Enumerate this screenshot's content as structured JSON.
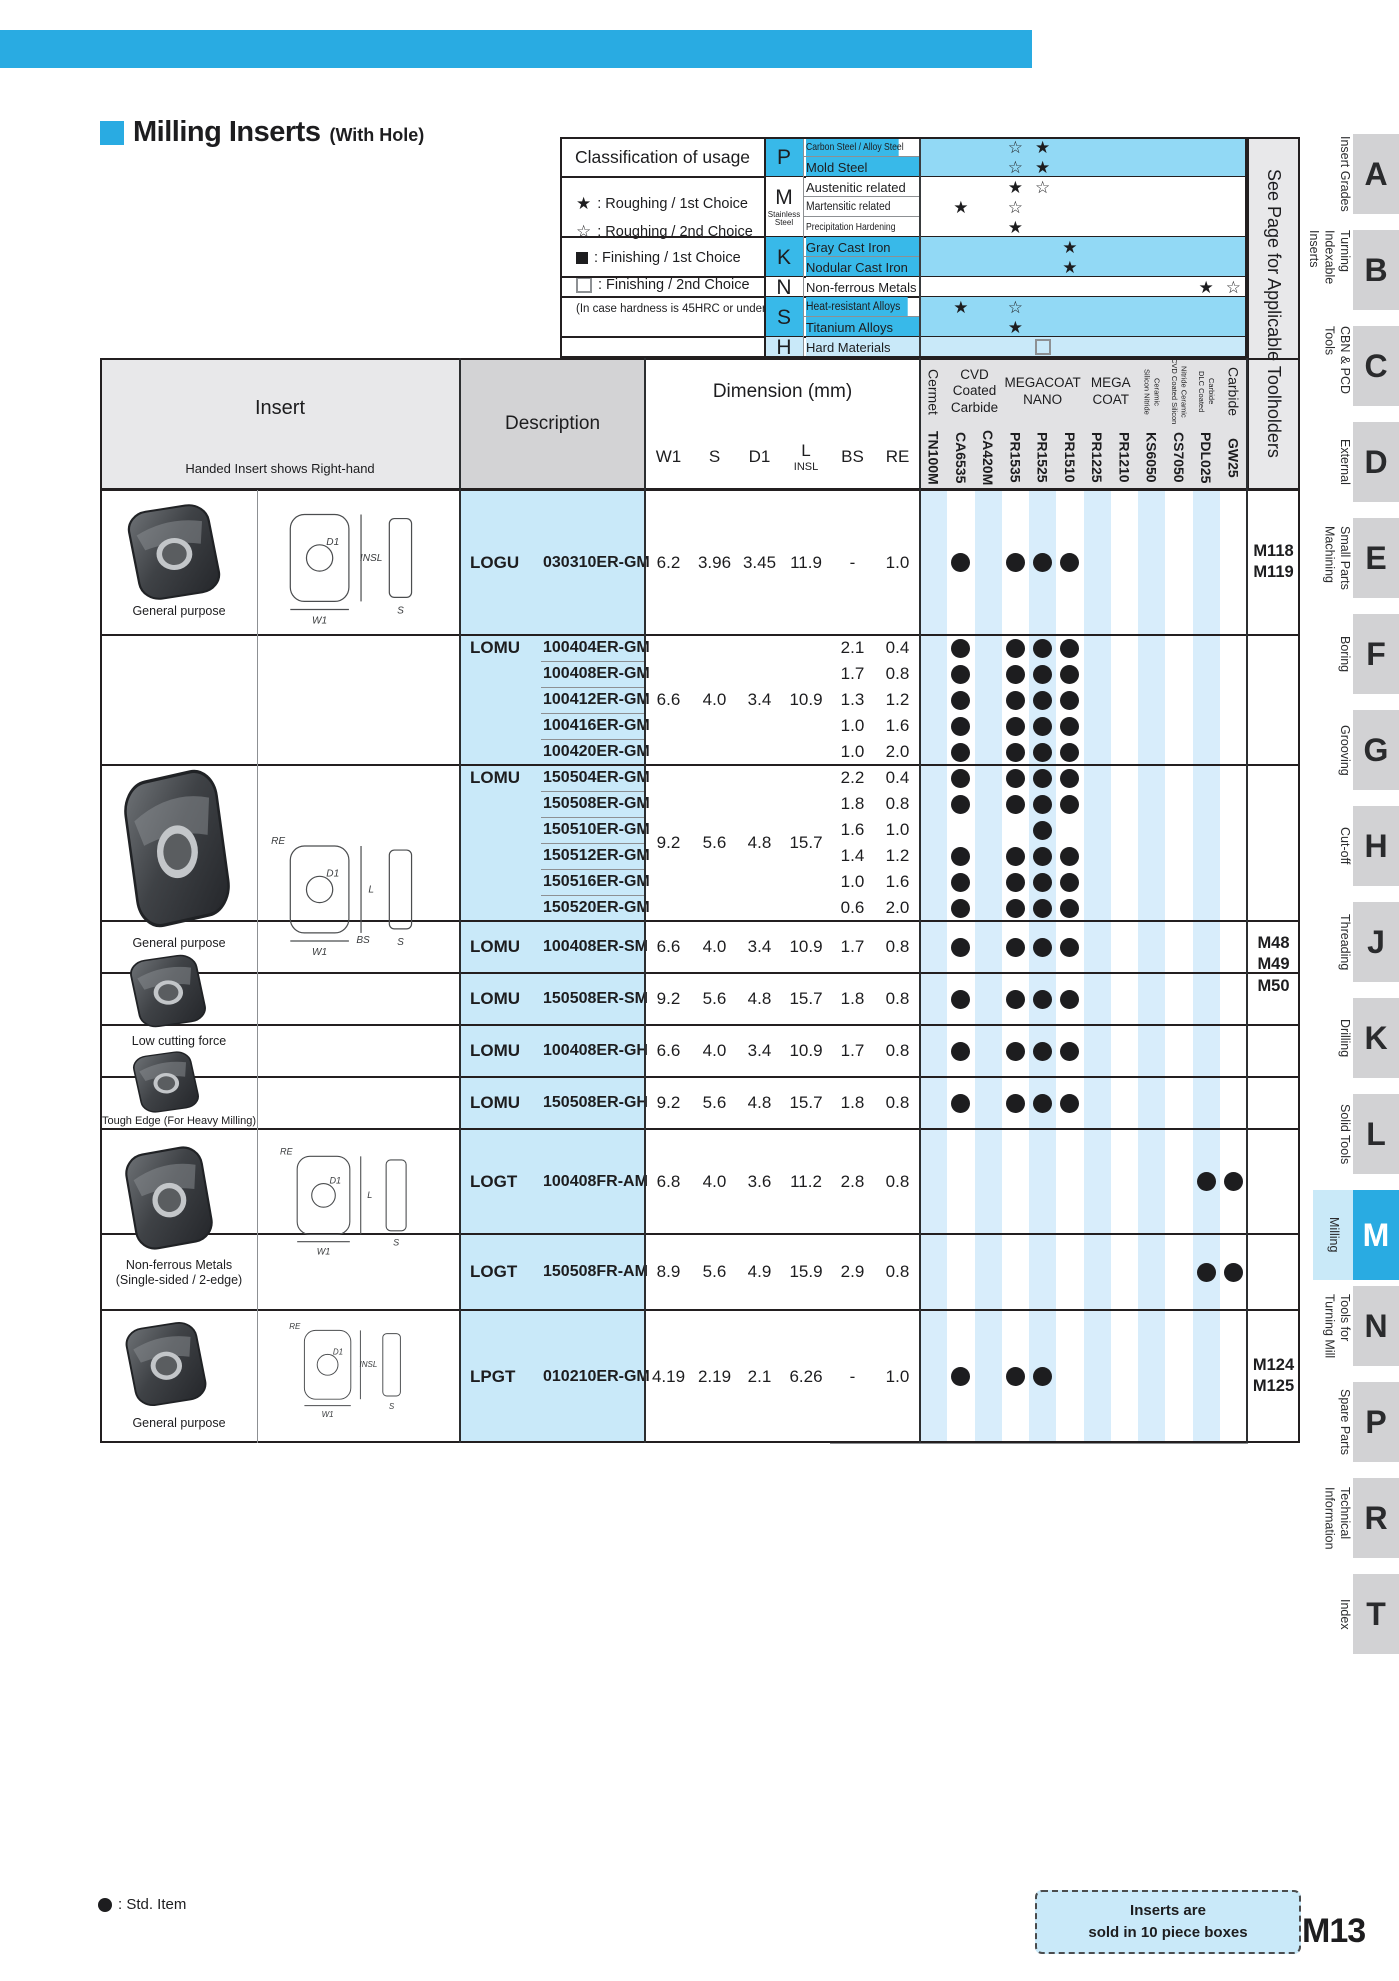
{
  "page": {
    "title": "Milling Inserts",
    "title_suffix": "(With Hole)",
    "std_item_legend": ": Std. Item",
    "box_note_line1": "Inserts are",
    "box_note_line2": "sold in 10 piece boxes",
    "page_number": "M13"
  },
  "colors": {
    "accent": "#29abe2",
    "class_label": "#38b9e9",
    "class_grid": "#92d9f5",
    "lightblue": "#c9e9f9",
    "col_shade": "#d8edfb",
    "head_gray1": "#e8e8ea",
    "head_gray2": "#d3d3d5",
    "head_gray3": "#e2e2e4",
    "tab_gray": "#d2d2d4",
    "tab_active_label_bg": "#c9e9f8",
    "border_dark": "#231f20",
    "border_mid": "#8d9093",
    "ink": "#1d1d1f"
  },
  "classification": {
    "header": "Classification of usage",
    "legend": [
      {
        "sym": "star_filled",
        "text": ": Roughing / 1st Choice"
      },
      {
        "sym": "star_open",
        "text": ": Roughing / 2nd Choice"
      },
      {
        "sym": "square_filled",
        "text": ": Finishing / 1st Choice"
      },
      {
        "sym": "square_open",
        "text": ": Finishing / 2nd Choice"
      },
      {
        "sym": "none",
        "text": "(In case hardness is 45HRC or under)"
      }
    ],
    "groups": [
      {
        "letter": "P",
        "sub": "",
        "shade": "cyan",
        "rows": [
          {
            "label": "Carbon Steel / Alloy Steel",
            "marks": {
              "3": "star_open",
              "4": "star_filled"
            }
          },
          {
            "label": "Mold Steel",
            "marks": {
              "3": "star_open",
              "4": "star_filled"
            }
          }
        ]
      },
      {
        "letter": "M",
        "sub": "Stainless Steel",
        "shade": "white",
        "rows": [
          {
            "label": "Austenitic related",
            "marks": {
              "3": "star_filled",
              "4": "star_open"
            }
          },
          {
            "label": "Martensitic related",
            "marks": {
              "1": "star_filled",
              "3": "star_open"
            }
          },
          {
            "label": "Precipitation Hardening",
            "marks": {
              "3": "star_filled"
            }
          }
        ]
      },
      {
        "letter": "K",
        "sub": "",
        "shade": "cyan",
        "rows": [
          {
            "label": "Gray Cast Iron",
            "marks": {
              "5": "star_filled"
            }
          },
          {
            "label": "Nodular Cast Iron",
            "marks": {
              "5": "star_filled"
            }
          }
        ]
      },
      {
        "letter": "N",
        "sub": "",
        "shade": "white",
        "rows": [
          {
            "label": "Non-ferrous Metals",
            "marks": {
              "10": "star_filled",
              "11": "star_open"
            }
          }
        ]
      },
      {
        "letter": "S",
        "sub": "",
        "shade": "cyan",
        "rows": [
          {
            "label": "Heat-resistant Alloys",
            "marks": {
              "1": "star_filled",
              "3": "star_open"
            }
          },
          {
            "label": "Titanium Alloys",
            "marks": {
              "3": "star_filled"
            }
          }
        ]
      },
      {
        "letter": "H",
        "sub": "",
        "shade": "lightblue",
        "rows": [
          {
            "label": "Hard Materials",
            "marks": {
              "4": "square_open"
            }
          }
        ]
      }
    ]
  },
  "table": {
    "insert_header": "Insert",
    "insert_note": "Handed Insert shows Right-hand",
    "description_header": "Description",
    "dimension_header": "Dimension (mm)",
    "dim_columns": [
      [
        "W1"
      ],
      [
        "S"
      ],
      [
        "D1"
      ],
      [
        "L",
        "INSL"
      ],
      [
        "BS"
      ],
      [
        "RE"
      ]
    ],
    "grade_groups": [
      {
        "lines": [
          "Cermet"
        ],
        "span": 1,
        "mode": "v"
      },
      {
        "lines": [
          "CVD",
          "Coated",
          "Carbide"
        ],
        "span": 2,
        "mode": "h"
      },
      {
        "lines": [
          "MEGACOAT",
          "NANO"
        ],
        "span": 3,
        "mode": "h"
      },
      {
        "lines": [
          "MEGA",
          "COAT"
        ],
        "span": 2,
        "mode": "h"
      },
      {
        "lines": [
          "Silicon Nitride",
          "Ceramic"
        ],
        "span": 1,
        "mode": "vs"
      },
      {
        "lines": [
          "CVD Coated Silicon",
          "Nitride Ceramic"
        ],
        "span": 1,
        "mode": "vs"
      },
      {
        "lines": [
          "DLC Coated",
          "Carbide"
        ],
        "span": 1,
        "mode": "vs"
      },
      {
        "lines": [
          "Carbide"
        ],
        "span": 1,
        "mode": "v"
      }
    ],
    "grades": [
      "TN100M",
      "CA6535",
      "CA420M",
      "PR1535",
      "PR1525",
      "PR1510",
      "PR1225",
      "PR1210",
      "KS6050",
      "CS7050",
      "PDL025",
      "GW25"
    ],
    "see_page_header": "See Page for Applicable Toolholders",
    "sections": [
      {
        "id": "logu",
        "series": "LOGU",
        "dims": {
          "w1": "6.2",
          "s": "3.96",
          "d1": "3.45",
          "l": "11.9"
        },
        "rows": [
          {
            "code": "030310ER-GM",
            "bs": "-",
            "re": "1.0",
            "dots": [
              1,
              3,
              4,
              5
            ]
          }
        ]
      },
      {
        "id": "gm1",
        "series": "LOMU",
        "dims": {
          "w1": "6.6",
          "s": "4.0",
          "d1": "3.4",
          "l": "10.9"
        },
        "rows": [
          {
            "code": "100404ER-GM",
            "bs": "2.1",
            "re": "0.4",
            "dots": [
              1,
              3,
              4,
              5
            ]
          },
          {
            "code": "100408ER-GM",
            "bs": "1.7",
            "re": "0.8",
            "dots": [
              1,
              3,
              4,
              5
            ]
          },
          {
            "code": "100412ER-GM",
            "bs": "1.3",
            "re": "1.2",
            "dots": [
              1,
              3,
              4,
              5
            ]
          },
          {
            "code": "100416ER-GM",
            "bs": "1.0",
            "re": "1.6",
            "dots": [
              1,
              3,
              4,
              5
            ]
          },
          {
            "code": "100420ER-GM",
            "bs": "1.0",
            "re": "2.0",
            "dots": [
              1,
              3,
              4,
              5
            ]
          }
        ]
      },
      {
        "id": "gm2",
        "series": "LOMU",
        "dims": {
          "w1": "9.2",
          "s": "5.6",
          "d1": "4.8",
          "l": "15.7"
        },
        "rows": [
          {
            "code": "150504ER-GM",
            "bs": "2.2",
            "re": "0.4",
            "dots": [
              1,
              3,
              4,
              5
            ]
          },
          {
            "code": "150508ER-GM",
            "bs": "1.8",
            "re": "0.8",
            "dots": [
              1,
              3,
              4,
              5
            ]
          },
          {
            "code": "150510ER-GM",
            "bs": "1.6",
            "re": "1.0",
            "dots": [
              4
            ]
          },
          {
            "code": "150512ER-GM",
            "bs": "1.4",
            "re": "1.2",
            "dots": [
              1,
              3,
              4,
              5
            ]
          },
          {
            "code": "150516ER-GM",
            "bs": "1.0",
            "re": "1.6",
            "dots": [
              1,
              3,
              4,
              5
            ]
          },
          {
            "code": "150520ER-GM",
            "bs": "0.6",
            "re": "2.0",
            "dots": [
              1,
              3,
              4,
              5
            ]
          }
        ]
      },
      {
        "id": "sm1",
        "series": "LOMU",
        "dims": {
          "w1": "6.6",
          "s": "4.0",
          "d1": "3.4",
          "l": "10.9"
        },
        "rows": [
          {
            "code": "100408ER-SM",
            "bs": "1.7",
            "re": "0.8",
            "dots": [
              1,
              3,
              4,
              5
            ]
          }
        ]
      },
      {
        "id": "sm2",
        "series": "LOMU",
        "dims": {
          "w1": "9.2",
          "s": "5.6",
          "d1": "4.8",
          "l": "15.7"
        },
        "rows": [
          {
            "code": "150508ER-SM",
            "bs": "1.8",
            "re": "0.8",
            "dots": [
              1,
              3,
              4,
              5
            ]
          }
        ]
      },
      {
        "id": "gh1",
        "series": "LOMU",
        "dims": {
          "w1": "6.6",
          "s": "4.0",
          "d1": "3.4",
          "l": "10.9"
        },
        "rows": [
          {
            "code": "100408ER-GH",
            "bs": "1.7",
            "re": "0.8",
            "dots": [
              1,
              3,
              4,
              5
            ]
          }
        ]
      },
      {
        "id": "gh2",
        "series": "LOMU",
        "dims": {
          "w1": "9.2",
          "s": "5.6",
          "d1": "4.8",
          "l": "15.7"
        },
        "rows": [
          {
            "code": "150508ER-GH",
            "bs": "1.8",
            "re": "0.8",
            "dots": [
              1,
              3,
              4,
              5
            ]
          }
        ]
      },
      {
        "id": "logt1",
        "series": "LOGT",
        "dims": {
          "w1": "6.8",
          "s": "4.0",
          "d1": "3.6",
          "l": "11.2"
        },
        "rows": [
          {
            "code": "100408FR-AM",
            "bs": "2.8",
            "re": "0.8",
            "dots": [
              10,
              11
            ]
          }
        ]
      },
      {
        "id": "logt2",
        "series": "LOGT",
        "dims": {
          "w1": "8.9",
          "s": "5.6",
          "d1": "4.9",
          "l": "15.9"
        },
        "rows": [
          {
            "code": "150508FR-AM",
            "bs": "2.9",
            "re": "0.8",
            "dots": [
              10,
              11
            ]
          }
        ]
      },
      {
        "id": "lpgt",
        "series": "LPGT",
        "dims": {
          "w1": "4.19",
          "s": "2.19",
          "d1": "2.1",
          "l": "6.26"
        },
        "rows": [
          {
            "code": "010210ER-GM",
            "bs": "-",
            "re": "1.0",
            "dots": [
              1,
              3,
              4
            ]
          }
        ]
      }
    ],
    "see_spans": [
      {
        "id": "logu",
        "values": [
          "M118",
          "M119"
        ],
        "yc": 562
      },
      {
        "id": "mid",
        "values": [
          "M48",
          "M49",
          "M50"
        ],
        "yc": 965
      },
      {
        "id": "lpgt",
        "values": [
          "M124",
          "M125"
        ],
        "yc": 1376
      }
    ],
    "insert_groups": [
      {
        "photos": [
          {
            "caption": [
              "General purpose"
            ]
          }
        ],
        "drawing": {
          "len": "INSL",
          "d1": "D1",
          "w1": "W1",
          "s": "S"
        }
      },
      {
        "photos": [
          {
            "caption": [
              "General purpose"
            ]
          },
          {
            "caption": [
              "Low cutting force"
            ]
          },
          {
            "caption": [
              "Tough Edge (For Heavy Milling)"
            ]
          }
        ],
        "drawing": {
          "re": "RE",
          "len": "L",
          "d1": "D1",
          "bs": "BS",
          "w1": "W1",
          "s": "S"
        }
      },
      {
        "photos": [
          {
            "caption": [
              "Non-ferrous Metals",
              "(Single-sided / 2-edge)"
            ]
          }
        ],
        "drawing": {
          "re": "RE",
          "len": "L",
          "d1": "D1",
          "w1": "W1",
          "s": "S"
        }
      },
      {
        "photos": [
          {
            "caption": [
              "General purpose"
            ]
          }
        ],
        "drawing": {
          "re": "RE",
          "len": "INSL",
          "d1": "D1",
          "w1": "W1",
          "s": "S"
        }
      }
    ]
  },
  "sidebar": {
    "tabs": [
      {
        "letter": "A",
        "label": [
          "Insert Grades"
        ],
        "active": false
      },
      {
        "letter": "B",
        "label": [
          "Turning",
          "Indexable Inserts"
        ],
        "active": false
      },
      {
        "letter": "C",
        "label": [
          "CBN & PCD Tools"
        ],
        "active": false
      },
      {
        "letter": "D",
        "label": [
          "External"
        ],
        "active": false
      },
      {
        "letter": "E",
        "label": [
          "Small Parts",
          "Machining"
        ],
        "active": false
      },
      {
        "letter": "F",
        "label": [
          "Boring"
        ],
        "active": false
      },
      {
        "letter": "G",
        "label": [
          "Grooving"
        ],
        "active": false
      },
      {
        "letter": "H",
        "label": [
          "Cut-off"
        ],
        "active": false
      },
      {
        "letter": "J",
        "label": [
          "Threading"
        ],
        "active": false
      },
      {
        "letter": "K",
        "label": [
          "Drilling"
        ],
        "active": false
      },
      {
        "letter": "L",
        "label": [
          "Solid Tools"
        ],
        "active": false
      },
      {
        "letter": "M",
        "label": [
          "Milling"
        ],
        "active": true
      },
      {
        "letter": "N",
        "label": [
          "Tools for",
          "Turning Mill"
        ],
        "active": false
      },
      {
        "letter": "P",
        "label": [
          "Spare Parts"
        ],
        "active": false
      },
      {
        "letter": "R",
        "label": [
          "Technical",
          "Information"
        ],
        "active": false
      },
      {
        "letter": "T",
        "label": [
          "Index"
        ],
        "active": false
      }
    ]
  }
}
